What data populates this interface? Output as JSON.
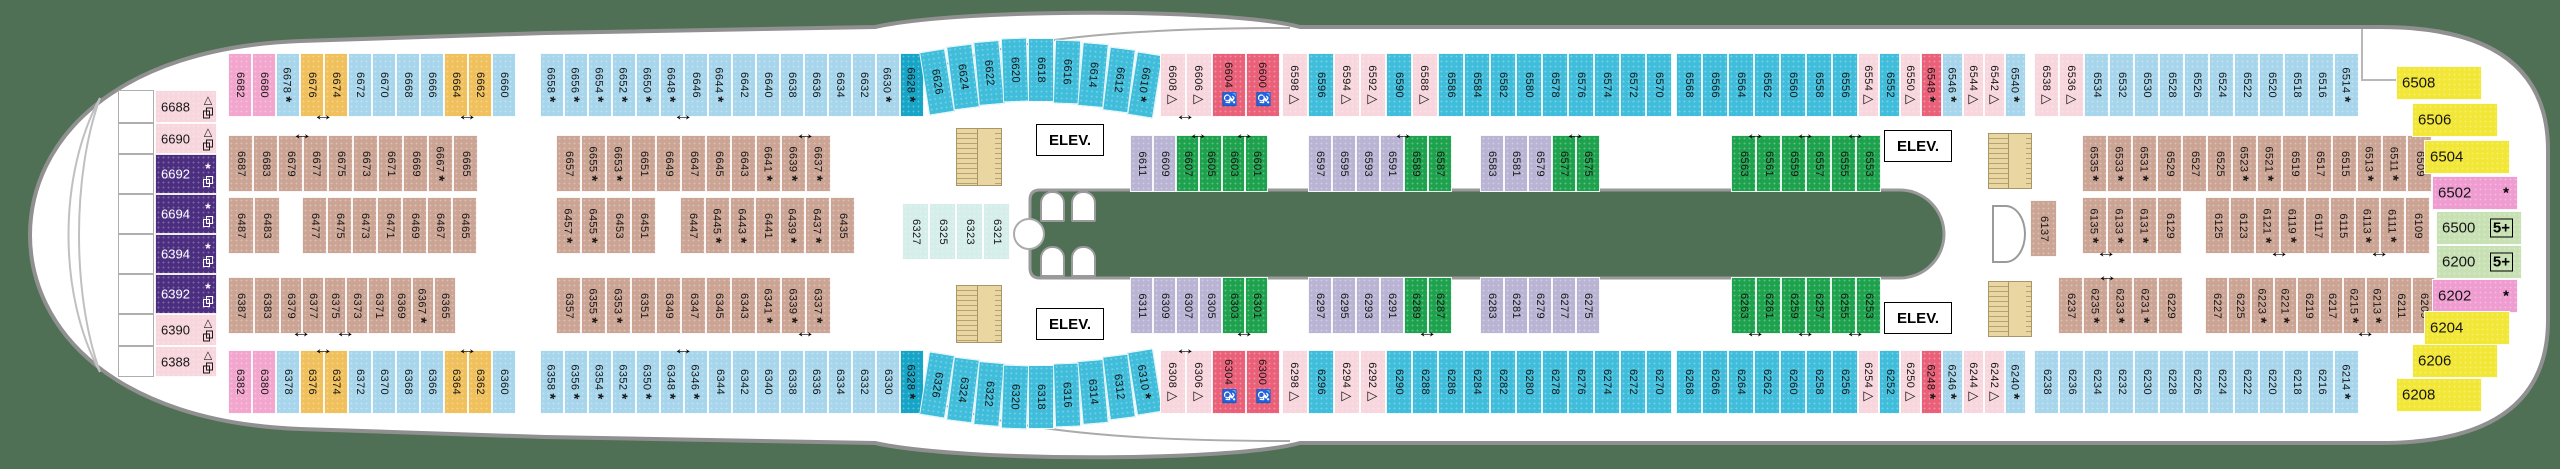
{
  "deck_plan": {
    "elevator_label": "ELEV.",
    "symbols": {
      "asterisk": "*",
      "triangle": "△",
      "wheelchair": "♿",
      "five_plus": "5+"
    },
    "colors": {
      "background": "#4f7055",
      "hull": "#ffffff",
      "hull_outline": "#909090",
      "balcony_light_blue": "#a7d6ec",
      "balcony_teal": "#3fbdda",
      "balcony_dark_teal": "#16a5c6",
      "yellow_connecting": "#f0c05c",
      "pink_forward": "#f3a6cd",
      "light_pink_triangle": "#f7d6de",
      "purple_suite": "#4b2e80",
      "red_accessible": "#e96078",
      "tan_inside": "#cba494",
      "lavender_inside": "#bab4d4",
      "green_inside": "#1fa24d",
      "light_teal_inside": "#d5eeea",
      "stern_yellow": "#f2e636",
      "stern_magenta": "#ef9cd1",
      "stern_light_green": "#c8e1b4"
    },
    "bow_cabins": [
      {
        "n": "6688",
        "c": "lp",
        "s": "tp",
        "y": 90,
        "h": 33
      },
      {
        "n": "6690",
        "c": "lp",
        "s": "tp",
        "y": 123,
        "h": 31
      },
      {
        "n": "6692",
        "c": "purp",
        "s": "ap",
        "y": 154,
        "h": 40
      },
      {
        "n": "6694",
        "c": "purp",
        "s": "ap",
        "y": 194,
        "h": 40
      },
      {
        "n": "6394",
        "c": "purp",
        "s": "ap",
        "y": 234,
        "h": 40
      },
      {
        "n": "6392",
        "c": "purp",
        "s": "ap",
        "y": 274,
        "h": 40
      },
      {
        "n": "6390",
        "c": "lp",
        "s": "tp",
        "y": 314,
        "h": 32
      },
      {
        "n": "6388",
        "c": "lp",
        "s": "tp",
        "y": 346,
        "h": 31
      }
    ],
    "stern_cabins": [
      {
        "n": "6508",
        "c": "y2",
        "s": "",
        "x": 2396,
        "y": 66
      },
      {
        "n": "6506",
        "c": "y2",
        "s": "",
        "x": 2412,
        "y": 103
      },
      {
        "n": "6504",
        "c": "y2",
        "s": "",
        "x": 2424,
        "y": 140
      },
      {
        "n": "6502",
        "c": "mag",
        "s": "a",
        "x": 2432,
        "y": 176
      },
      {
        "n": "6500",
        "c": "lg",
        "s": "f",
        "x": 2436,
        "y": 211
      },
      {
        "n": "6200",
        "c": "lg",
        "s": "f",
        "x": 2436,
        "y": 245
      },
      {
        "n": "6202",
        "c": "mag",
        "s": "a",
        "x": 2432,
        "y": 279
      },
      {
        "n": "6204",
        "c": "y2",
        "s": "",
        "x": 2424,
        "y": 311
      },
      {
        "n": "6206",
        "c": "y2",
        "s": "",
        "x": 2412,
        "y": 344
      },
      {
        "n": "6208",
        "c": "y2",
        "s": "",
        "x": 2396,
        "y": 378
      }
    ],
    "rows": {
      "A": {
        "y": 53,
        "h": 64,
        "segments": [
          {
            "x": 228,
            "w": 24,
            "cells": [
              "6682|pink",
              "6680|pink",
              "6678|lb|a",
              "6676|yel",
              "6674|yel||1",
              "6672|lb",
              "6670|lb",
              "6668|lb",
              "6666|lb",
              "6664|yel",
              "6662|yel||1",
              "6660|lb"
            ]
          },
          {
            "x": 540,
            "w": 24,
            "cells": [
              "6658|lb|a",
              "6656|lb|a",
              "6654|lb|a",
              "6652|lb|a",
              "6650|lb|a",
              "6648|lb|a",
              "6646|lb||1",
              "6644|lb|a",
              "6642|lb",
              "6640|lb",
              "6638|lb",
              "6636|lb",
              "6634|lb",
              "6632|lb",
              "6630|lb|a",
              "6628|dt|a"
            ]
          },
          {
            "x": 924,
            "w": 26,
            "arc": "up",
            "cells": [
              "6626|t",
              "6624|t",
              "6622|t",
              "6620|t",
              "6618|t",
              "6616|t",
              "6614|t",
              "6612|t",
              "6610|t|a"
            ]
          },
          {
            "x": 1160,
            "w": 26,
            "cells": [
              "6608|lp|t",
              "6606|lp|t|1"
            ]
          },
          {
            "x": 1212,
            "w": 34,
            "cells": [
              "6604|red|w",
              "6600|red|w"
            ]
          },
          {
            "x": 1282,
            "w": 26,
            "cells": [
              "6598|lp|t",
              "6596|t",
              "6594|lp|t",
              "6592|lp|t",
              "6590|t",
              "6588|lp|t",
              "6586|t",
              "6584|t",
              "6582|t",
              "6580|t",
              "6578|t",
              "6576|t",
              "6574|t",
              "6572|t",
              "6570|t"
            ]
          },
          {
            "x": 1676,
            "w": 26,
            "cells": [
              "6568|t",
              "6566|t",
              "6564|t",
              "6562|t",
              "6560|t",
              "6558|t",
              "6556|t"
            ]
          },
          {
            "x": 1858,
            "w": 21,
            "cells": [
              "6554|lp|t",
              "6552|t",
              "6550|lp|t",
              "6548|red|a",
              "6546|lb|a",
              "6544|lp|t",
              "6542|lp|t",
              "6540|lb|a"
            ]
          },
          {
            "x": 2034,
            "w": 25,
            "cells": [
              "6538|lp|t",
              "6536|lp|t",
              "6534|lb",
              "6532|lb",
              "6530|lb",
              "6528|lb",
              "6526|lb",
              "6524|lb",
              "6522|lb",
              "6520|lb",
              "6518|lb",
              "6516|lb",
              "6514|lb|a"
            ]
          }
        ]
      },
      "B": {
        "y": 135,
        "h": 57,
        "segments": [
          {
            "x": 228,
            "w": 25,
            "cells": [
              "6687|tan",
              "6683|tan",
              "6679|tan"
            ]
          },
          {
            "x": 303,
            "w": 25,
            "cells": [
              "6677|tan||2",
              "6675|tan",
              "6673|tan",
              "6671|tan",
              "6669|tan",
              "6667|tan|a",
              "6665|tan"
            ]
          },
          {
            "x": 556,
            "w": 25,
            "cells": [
              "6657|tan",
              "6655|tan|a",
              "6653|tan|a",
              "6651|tan",
              "6649|tan",
              "6647|tan",
              "6645|tan",
              "6643|tan",
              "6641|tan|a",
              "6639|tan|a",
              "6637|tan|a|2"
            ]
          },
          {
            "x": 1130,
            "w": 23,
            "cells": [
              "6611|lav",
              "6609|lav",
              "6607|grn",
              "6605|grn||2",
              "6603|grn",
              "6601|grn||2"
            ]
          },
          {
            "x": 1308,
            "w": 24,
            "cells": [
              "6597|lav",
              "6595|lav",
              "6593|lav",
              "6591|lav",
              "6589|grn||2",
              "6587|grn"
            ]
          },
          {
            "x": 1480,
            "w": 24,
            "cells": [
              "6583|lav",
              "6581|lav",
              "6579|lav",
              "6577|grn",
              "6575|grn||2"
            ]
          },
          {
            "x": 1731,
            "w": 25,
            "cells": [
              "6563|grn",
              "6561|grn||2",
              "6559|grn",
              "6557|grn||2",
              "6555|grn",
              "6553|grn||2"
            ]
          },
          {
            "x": 2082,
            "w": 25,
            "cells": [
              "6535|tan|a",
              "6533|tan|a",
              "6531|tan|a",
              "6529|tan",
              "6527|tan",
              "6525|tan",
              "6523|tan|a",
              "6521|tan|a",
              "6519|tan",
              "6517|tan",
              "6515|tan",
              "6513|tan|a",
              "6511|tan|a",
              "6509|tan"
            ]
          }
        ]
      },
      "C": {
        "y": 197,
        "h": 57,
        "segments": [
          {
            "x": 228,
            "w": 26,
            "cells": [
              "6487|tan",
              "6483|tan"
            ]
          },
          {
            "x": 302,
            "w": 25,
            "cells": [
              "6477|tan",
              "6475|tan",
              "6473|tan",
              "6471|tan",
              "6469|tan",
              "6467|tan",
              "6465|tan"
            ]
          },
          {
            "x": 556,
            "w": 25,
            "cells": [
              "6457|tan|a",
              "6455|tan|a",
              "6453|tan",
              "6451|tan"
            ]
          },
          {
            "x": 680,
            "w": 25,
            "cells": [
              "6447|tan",
              "6445|tan|a",
              "6443|tan|a",
              "6441|tan",
              "6439|tan|a",
              "6437|tan|a",
              "6435|tan"
            ]
          },
          {
            "x": 902,
            "w": 27,
            "dy": 6,
            "cells": [
              "6327|lt",
              "6325|lt",
              "6323|lt",
              "6321|lt"
            ]
          },
          {
            "x": 2030,
            "w": 27,
            "dy": 3,
            "cells": [
              "6137|tan"
            ]
          },
          {
            "x": 2082,
            "w": 25,
            "cells": [
              "6135|tan|a",
              "6133|tan|a|1",
              "6131|tan|a",
              "6129|tan"
            ]
          },
          {
            "x": 2205,
            "w": 25,
            "cells": [
              "6125|tan",
              "6123|tan",
              "6121|tan|a",
              "6119|tan|a|1",
              "6117|tan",
              "6115|tan",
              "6113|tan|a",
              "6111|tan|a|1",
              "6109|tan"
            ]
          }
        ]
      },
      "D": {
        "y": 277,
        "h": 57,
        "segments": [
          {
            "x": 228,
            "w": 26,
            "cells": [
              "6387|tan",
              "6383|tan"
            ]
          },
          {
            "x": 280,
            "w": 22,
            "cells": [
              "6379|tan",
              "6377|tan||1",
              "6375|tan",
              "6373|tan||1",
              "6371|tan",
              "6369|tan",
              "6367|tan|a",
              "6365|tan"
            ]
          },
          {
            "x": 556,
            "w": 25,
            "cells": [
              "6357|tan",
              "6355|tan|a",
              "6353|tan|a",
              "6351|tan",
              "6349|tan",
              "6347|tan",
              "6345|tan",
              "6343|tan",
              "6341|tan|a",
              "6339|tan|a",
              "6337|tan|a|1"
            ]
          },
          {
            "x": 1130,
            "w": 23,
            "cells": [
              "6311|lav",
              "6309|lav",
              "6307|lav",
              "6305|lav",
              "6303|grn",
              "6301|grn||1"
            ]
          },
          {
            "x": 1308,
            "w": 24,
            "cells": [
              "6297|lav",
              "6295|lav",
              "6293|lav",
              "6291|lav",
              "6289|grn",
              "6287|grn||1"
            ]
          },
          {
            "x": 1480,
            "w": 24,
            "cells": [
              "6283|lav",
              "6281|lav",
              "6279|lav",
              "6277|lav",
              "6275|lav"
            ]
          },
          {
            "x": 1731,
            "w": 25,
            "cells": [
              "6263|grn",
              "6261|grn||1",
              "6259|grn",
              "6257|grn||1",
              "6255|grn",
              "6253|grn||1"
            ]
          },
          {
            "x": 2058,
            "w": 25,
            "cells": [
              "6237|tan",
              "6235|tan|a",
              "6233|tan|a|2",
              "6231|tan|a",
              "6229|tan"
            ]
          },
          {
            "x": 2205,
            "w": 23,
            "cells": [
              "6227|tan",
              "6225|tan",
              "6223|tan|a",
              "6221|tan|a",
              "6219|tan",
              "6217|tan",
              "6215|tan|a",
              "6213|tan|a|1",
              "6211|tan",
              "6209|tan"
            ]
          }
        ]
      },
      "E": {
        "y": 350,
        "h": 64,
        "segments": [
          {
            "x": 228,
            "w": 24,
            "cells": [
              "6382|pink",
              "6380|pink",
              "6378|lb",
              "6376|yel",
              "6374|yel||2",
              "6372|lb",
              "6370|lb",
              "6368|lb",
              "6366|lb",
              "6364|yel",
              "6362|yel||2",
              "6360|lb"
            ]
          },
          {
            "x": 540,
            "w": 24,
            "cells": [
              "6358|lb|a",
              "6356|lb|a",
              "6354|lb|a",
              "6352|lb|a",
              "6350|lb|a",
              "6348|lb|a",
              "6346|lb|a|2",
              "6344|lb",
              "6342|lb",
              "6340|lb",
              "6338|lb",
              "6336|lb",
              "6334|lb",
              "6332|lb",
              "6330|lb",
              "6328|dt|a"
            ]
          },
          {
            "x": 924,
            "w": 26,
            "arc": "down",
            "cells": [
              "6326|t",
              "6324|t",
              "6322|t",
              "6320|t",
              "6318|t",
              "6316|t",
              "6314|t",
              "6312|t",
              "6310|t|a"
            ]
          },
          {
            "x": 1160,
            "w": 26,
            "cells": [
              "6308|lp|t",
              "6306|lp|t|2"
            ]
          },
          {
            "x": 1212,
            "w": 34,
            "cells": [
              "6304|red|w",
              "6300|red|w"
            ]
          },
          {
            "x": 1282,
            "w": 26,
            "cells": [
              "6298|lp|t",
              "6296|t",
              "6294|lp|t",
              "6292|lp|t",
              "6290|t",
              "6288|t",
              "6286|t",
              "6284|t",
              "6282|t",
              "6280|t",
              "6278|t",
              "6276|t",
              "6274|t",
              "6272|t",
              "6270|t"
            ]
          },
          {
            "x": 1676,
            "w": 26,
            "cells": [
              "6268|t",
              "6266|t",
              "6264|t",
              "6262|t",
              "6260|t",
              "6258|t",
              "6256|t"
            ]
          },
          {
            "x": 1858,
            "w": 21,
            "cells": [
              "6254|lp|t",
              "6252|t",
              "6250|lp|t",
              "6248|red|a",
              "6246|lb|a",
              "6244|lp|t",
              "6242|lp|t",
              "6240|lb|a"
            ]
          },
          {
            "x": 2034,
            "w": 25,
            "cells": [
              "6238|lb",
              "6236|lb",
              "6234|lb",
              "6232|lb",
              "6230|lb",
              "6228|lb",
              "6226|lb",
              "6224|lb",
              "6222|lb",
              "6220|lb",
              "6218|lb",
              "6216|lb",
              "6214|lb|a"
            ]
          }
        ]
      }
    }
  }
}
